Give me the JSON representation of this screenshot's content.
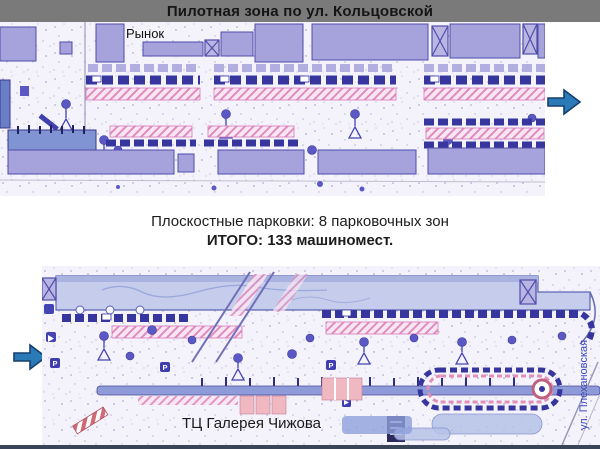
{
  "slide": {
    "title": "Пилотная зона по ул. Кольцовской",
    "summary": {
      "line1": "Плоскостные парковки:  8 парковочных зон",
      "line2": "ИТОГО: 133 машиномест."
    },
    "top_map": {
      "market_label": "Рынок"
    },
    "bottom_map": {
      "mall_label": "ТЦ Галерея Чижова",
      "street_label": "ул. Плехановская"
    },
    "icons": {
      "arrow_top": "arrow-right-icon",
      "arrow_bottom": "arrow-right-icon"
    },
    "colors": {
      "title_bar": "#7a7a7a",
      "title_text": "#151515",
      "arrow_fill": "#2b7ab8",
      "arrow_stroke": "#173f6e",
      "building_fill": "#a5a2dc",
      "building_stroke": "#504da8",
      "parking_navy": "#37359e",
      "hatch_pink": "#e08cc0",
      "map_background": "#f4f3fb",
      "street_label_blue": "#3c49c0",
      "bottom_border": "#3a4458"
    }
  }
}
